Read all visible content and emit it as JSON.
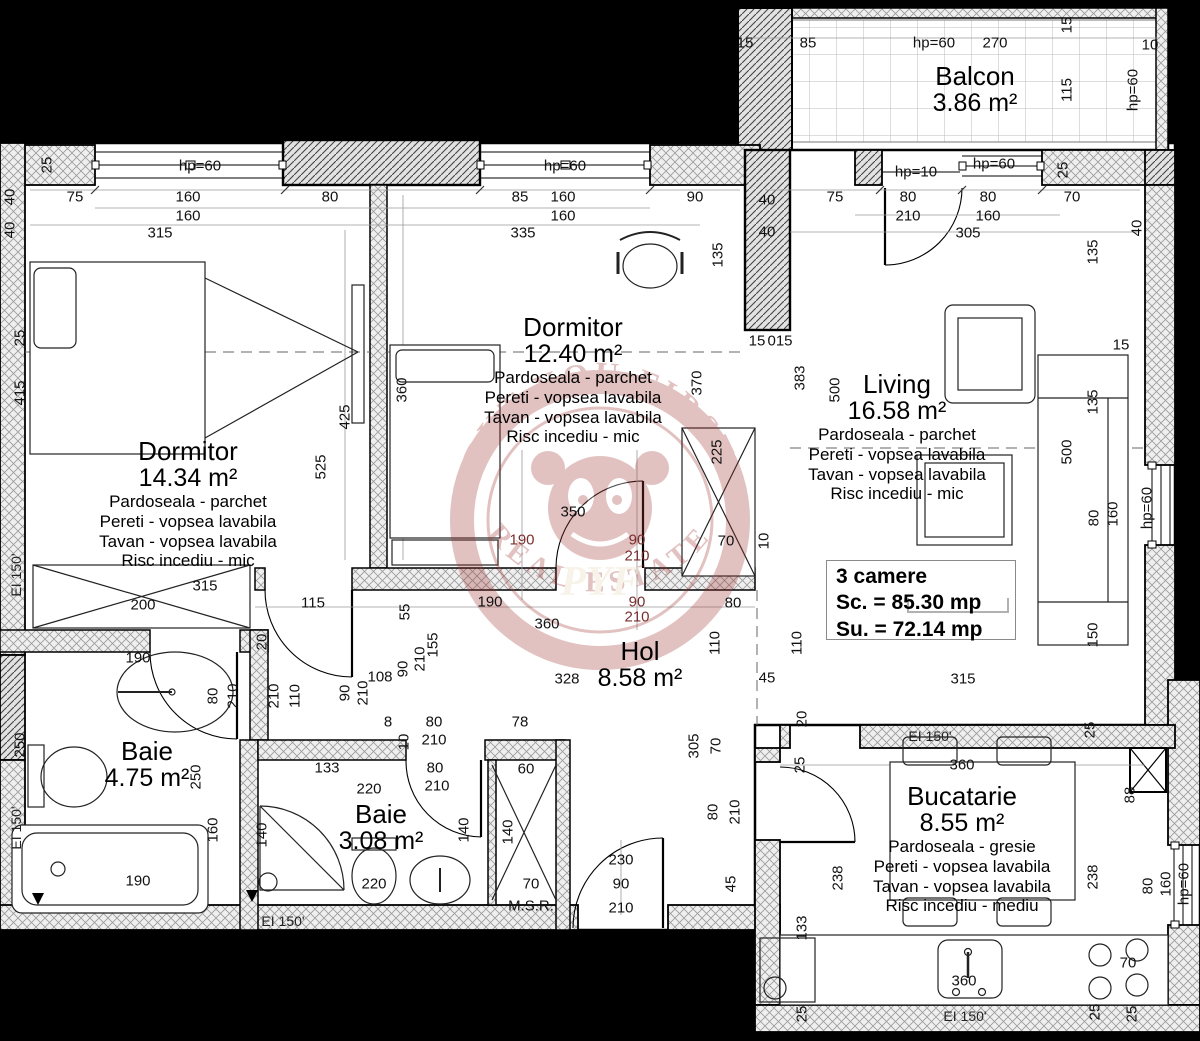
{
  "watermark": {
    "top": "PUT YOU FIRST",
    "bottom": "REAL ESTATE",
    "monogram": "PYF",
    "color": "#a23535"
  },
  "summary": {
    "rooms": "3 camere",
    "sc": "Sc. = 85.30 mp",
    "su": "Su. = 72.14 mp"
  },
  "rooms": [
    {
      "id": "dormitor-1",
      "name": "Dormitor",
      "area": "14.34 m²",
      "x": 188,
      "y": 437,
      "finishes": [
        "Pardoseala - parchet",
        "Pereti - vopsea lavabila",
        "Tavan - vopsea lavabila",
        "Risc incediu - mic"
      ]
    },
    {
      "id": "dormitor-2",
      "name": "Dormitor",
      "area": "12.40 m²",
      "x": 573,
      "y": 313,
      "finishes": [
        "Pardoseala - parchet",
        "Pereti - vopsea lavabila",
        "Tavan - vopsea lavabila",
        "Risc incediu - mic"
      ]
    },
    {
      "id": "living",
      "name": "Living",
      "area": "16.58 m²",
      "x": 897,
      "y": 370,
      "finishes": [
        "Pardoseala - parchet",
        "Pereti - vopsea lavabila",
        "Tavan - vopsea lavabila",
        "Risc incediu - mic"
      ]
    },
    {
      "id": "hol",
      "name": "Hol",
      "area": "8.58 m²",
      "x": 640,
      "y": 637,
      "finishes": []
    },
    {
      "id": "baie-1",
      "name": "Baie",
      "area": "4.75 m²",
      "x": 147,
      "y": 737,
      "finishes": []
    },
    {
      "id": "baie-2",
      "name": "Baie",
      "area": "3.08 m²",
      "x": 381,
      "y": 800,
      "finishes": []
    },
    {
      "id": "bucatarie",
      "name": "Bucatarie",
      "area": "8.55 m²",
      "x": 962,
      "y": 782,
      "finishes": [
        "Pardoseala - gresie",
        "Pereti - vopsea lavabila",
        "Tavan - vopsea lavabila",
        "Risc incediu - mediu"
      ]
    },
    {
      "id": "balcon",
      "name": "Balcon",
      "area": "3.86 m²",
      "x": 975,
      "y": 62,
      "finishes": []
    }
  ],
  "labels": [
    {
      "t": "75",
      "x": 75,
      "y": 197
    },
    {
      "t": "160",
      "x": 188,
      "y": 197
    },
    {
      "t": "160",
      "x": 188,
      "y": 216
    },
    {
      "t": "80",
      "x": 330,
      "y": 197
    },
    {
      "t": "85",
      "x": 520,
      "y": 197
    },
    {
      "t": "160",
      "x": 563,
      "y": 197
    },
    {
      "t": "160",
      "x": 563,
      "y": 216
    },
    {
      "t": "90",
      "x": 695,
      "y": 197
    },
    {
      "t": "315",
      "x": 160,
      "y": 233
    },
    {
      "t": "335",
      "x": 523,
      "y": 233
    },
    {
      "t": "hp=60",
      "x": 200,
      "y": 166
    },
    {
      "t": "hp=60",
      "x": 565,
      "y": 166
    },
    {
      "t": "25",
      "x": 47,
      "y": 165,
      "r": 1
    },
    {
      "t": "40",
      "x": 10,
      "y": 197,
      "r": 1
    },
    {
      "t": "40",
      "x": 10,
      "y": 230,
      "r": 1
    },
    {
      "t": "75",
      "x": 835,
      "y": 197
    },
    {
      "t": "80",
      "x": 908,
      "y": 197
    },
    {
      "t": "210",
      "x": 908,
      "y": 216
    },
    {
      "t": "80",
      "x": 988,
      "y": 197
    },
    {
      "t": "160",
      "x": 988,
      "y": 216
    },
    {
      "t": "70",
      "x": 1072,
      "y": 197
    },
    {
      "t": "305",
      "x": 968,
      "y": 233
    },
    {
      "t": "hp=10",
      "x": 916,
      "y": 172
    },
    {
      "t": "hp=60",
      "x": 994,
      "y": 164
    },
    {
      "t": "25",
      "x": 1063,
      "y": 170,
      "r": 1
    },
    {
      "t": "40",
      "x": 1137,
      "y": 228,
      "r": 1
    },
    {
      "t": "40",
      "x": 767,
      "y": 200
    },
    {
      "t": "40",
      "x": 767,
      "y": 232
    },
    {
      "t": "15",
      "x": 745,
      "y": 43
    },
    {
      "t": "85",
      "x": 808,
      "y": 43
    },
    {
      "t": "hp=60",
      "x": 934,
      "y": 43
    },
    {
      "t": "270",
      "x": 995,
      "y": 43
    },
    {
      "t": "10",
      "x": 1150,
      "y": 45
    },
    {
      "t": "15",
      "x": 1067,
      "y": 25,
      "r": 1
    },
    {
      "t": "115",
      "x": 1067,
      "y": 90,
      "r": 1
    },
    {
      "t": "hp=60",
      "x": 1133,
      "y": 90,
      "r": 1
    },
    {
      "t": "25",
      "x": 20,
      "y": 338,
      "r": 1
    },
    {
      "t": "415",
      "x": 20,
      "y": 393,
      "r": 1
    },
    {
      "t": "250",
      "x": 20,
      "y": 745,
      "r": 1
    },
    {
      "t": "EI 150'",
      "x": 16,
      "y": 575,
      "r": 1,
      "c": "ei"
    },
    {
      "t": "EI 150'",
      "x": 16,
      "y": 828,
      "r": 1,
      "c": "ei"
    },
    {
      "t": "360",
      "x": 402,
      "y": 390,
      "r": 1
    },
    {
      "t": "425",
      "x": 345,
      "y": 417,
      "r": 1
    },
    {
      "t": "525",
      "x": 321,
      "y": 467,
      "r": 1
    },
    {
      "t": "135",
      "x": 718,
      "y": 255,
      "r": 1
    },
    {
      "t": "370",
      "x": 697,
      "y": 383,
      "r": 1
    },
    {
      "t": "225",
      "x": 717,
      "y": 452,
      "r": 1
    },
    {
      "t": "15",
      "x": 757,
      "y": 341
    },
    {
      "t": "015",
      "x": 780,
      "y": 341
    },
    {
      "t": "383",
      "x": 800,
      "y": 378,
      "r": 1
    },
    {
      "t": "500",
      "x": 835,
      "y": 390,
      "r": 1
    },
    {
      "t": "315",
      "x": 205,
      "y": 586
    },
    {
      "t": "200",
      "x": 143,
      "y": 605
    },
    {
      "t": "115",
      "x": 313,
      "y": 603
    },
    {
      "t": "190",
      "x": 138,
      "y": 658
    },
    {
      "t": "80",
      "x": 213,
      "y": 696,
      "r": 1
    },
    {
      "t": "210",
      "x": 233,
      "y": 696,
      "r": 1
    },
    {
      "t": "20",
      "x": 262,
      "y": 642,
      "r": 1
    },
    {
      "t": "250",
      "x": 196,
      "y": 777,
      "r": 1
    },
    {
      "t": "160",
      "x": 213,
      "y": 830,
      "r": 1
    },
    {
      "t": "190",
      "x": 138,
      "y": 881
    },
    {
      "t": "EI 150'",
      "x": 283,
      "y": 921,
      "c": "ei"
    },
    {
      "t": "350",
      "x": 573,
      "y": 512
    },
    {
      "t": "190",
      "x": 522,
      "y": 540,
      "c": "red"
    },
    {
      "t": "90",
      "x": 637,
      "y": 540,
      "c": "red"
    },
    {
      "t": "210",
      "x": 637,
      "y": 556,
      "c": "red"
    },
    {
      "t": "70",
      "x": 726,
      "y": 541
    },
    {
      "t": "10",
      "x": 764,
      "y": 541,
      "r": 1
    },
    {
      "t": "190",
      "x": 490,
      "y": 602
    },
    {
      "t": "90",
      "x": 637,
      "y": 602,
      "c": "red"
    },
    {
      "t": "210",
      "x": 637,
      "y": 617,
      "c": "red"
    },
    {
      "t": "360",
      "x": 547,
      "y": 624
    },
    {
      "t": "328",
      "x": 567,
      "y": 679
    },
    {
      "t": "55",
      "x": 405,
      "y": 612,
      "r": 1
    },
    {
      "t": "155",
      "x": 433,
      "y": 645,
      "r": 1
    },
    {
      "t": "210",
      "x": 420,
      "y": 659,
      "r": 1
    },
    {
      "t": "90",
      "x": 403,
      "y": 669,
      "r": 1
    },
    {
      "t": "108",
      "x": 380,
      "y": 677
    },
    {
      "t": "110",
      "x": 295,
      "y": 696,
      "r": 1
    },
    {
      "t": "210",
      "x": 274,
      "y": 696,
      "r": 1
    },
    {
      "t": "90",
      "x": 345,
      "y": 693,
      "r": 1
    },
    {
      "t": "210",
      "x": 363,
      "y": 693,
      "r": 1
    },
    {
      "t": "110",
      "x": 715,
      "y": 643,
      "r": 1
    },
    {
      "t": "110",
      "x": 797,
      "y": 643,
      "r": 1
    },
    {
      "t": "80",
      "x": 733,
      "y": 603
    },
    {
      "t": "45",
      "x": 767,
      "y": 678
    },
    {
      "t": "8",
      "x": 388,
      "y": 722
    },
    {
      "t": "80",
      "x": 434,
      "y": 722
    },
    {
      "t": "210",
      "x": 434,
      "y": 740
    },
    {
      "t": "10",
      "x": 404,
      "y": 742,
      "r": 1
    },
    {
      "t": "78",
      "x": 520,
      "y": 722
    },
    {
      "t": "133",
      "x": 327,
      "y": 768
    },
    {
      "t": "220",
      "x": 369,
      "y": 789
    },
    {
      "t": "80",
      "x": 435,
      "y": 768
    },
    {
      "t": "210",
      "x": 437,
      "y": 786
    },
    {
      "t": "140",
      "x": 262,
      "y": 835,
      "r": 1
    },
    {
      "t": "140",
      "x": 464,
      "y": 830,
      "r": 1
    },
    {
      "t": "220",
      "x": 374,
      "y": 884
    },
    {
      "t": "60",
      "x": 526,
      "y": 769
    },
    {
      "t": "140",
      "x": 508,
      "y": 832,
      "r": 1
    },
    {
      "t": "70",
      "x": 531,
      "y": 884
    },
    {
      "t": "M.S.R.",
      "x": 531,
      "y": 906
    },
    {
      "t": "230",
      "x": 621,
      "y": 860
    },
    {
      "t": "90",
      "x": 621,
      "y": 884
    },
    {
      "t": "210",
      "x": 621,
      "y": 908
    },
    {
      "t": "305",
      "x": 694,
      "y": 746,
      "r": 1
    },
    {
      "t": "70",
      "x": 716,
      "y": 746,
      "r": 1
    },
    {
      "t": "80",
      "x": 713,
      "y": 812,
      "r": 1
    },
    {
      "t": "210",
      "x": 735,
      "y": 812,
      "r": 1
    },
    {
      "t": "45",
      "x": 731,
      "y": 884,
      "r": 1
    },
    {
      "t": "20",
      "x": 802,
      "y": 719,
      "r": 1
    },
    {
      "t": "25",
      "x": 800,
      "y": 765,
      "r": 1
    },
    {
      "t": "EI 150'",
      "x": 930,
      "y": 736,
      "c": "ei"
    },
    {
      "t": "360",
      "x": 962,
      "y": 765
    },
    {
      "t": "133",
      "x": 802,
      "y": 928,
      "r": 1
    },
    {
      "t": "238",
      "x": 838,
      "y": 878,
      "r": 1
    },
    {
      "t": "238",
      "x": 1093,
      "y": 877,
      "r": 1
    },
    {
      "t": "88",
      "x": 1130,
      "y": 795,
      "r": 1
    },
    {
      "t": "25",
      "x": 1090,
      "y": 730,
      "r": 1
    },
    {
      "t": "80",
      "x": 1148,
      "y": 886,
      "r": 1
    },
    {
      "t": "160",
      "x": 1166,
      "y": 884,
      "r": 1
    },
    {
      "t": "hp=60",
      "x": 1184,
      "y": 884,
      "r": 1
    },
    {
      "t": "70",
      "x": 1128,
      "y": 963
    },
    {
      "t": "360",
      "x": 964,
      "y": 981
    },
    {
      "t": "EI 150'",
      "x": 965,
      "y": 1016,
      "c": "ei"
    },
    {
      "t": "25",
      "x": 802,
      "y": 1014,
      "r": 1
    },
    {
      "t": "25",
      "x": 1095,
      "y": 1012,
      "r": 1
    },
    {
      "t": "25",
      "x": 1132,
      "y": 1014,
      "r": 1
    },
    {
      "t": "15",
      "x": 1121,
      "y": 345
    },
    {
      "t": "135",
      "x": 1093,
      "y": 402,
      "r": 1
    },
    {
      "t": "500",
      "x": 1067,
      "y": 452,
      "r": 1
    },
    {
      "t": "80",
      "x": 1094,
      "y": 518,
      "r": 1
    },
    {
      "t": "160",
      "x": 1113,
      "y": 514,
      "r": 1
    },
    {
      "t": "hp=60",
      "x": 1147,
      "y": 508,
      "r": 1
    },
    {
      "t": "150",
      "x": 1093,
      "y": 635,
      "r": 1
    },
    {
      "t": "315",
      "x": 963,
      "y": 679
    },
    {
      "t": "135",
      "x": 1093,
      "y": 252,
      "r": 1
    }
  ]
}
